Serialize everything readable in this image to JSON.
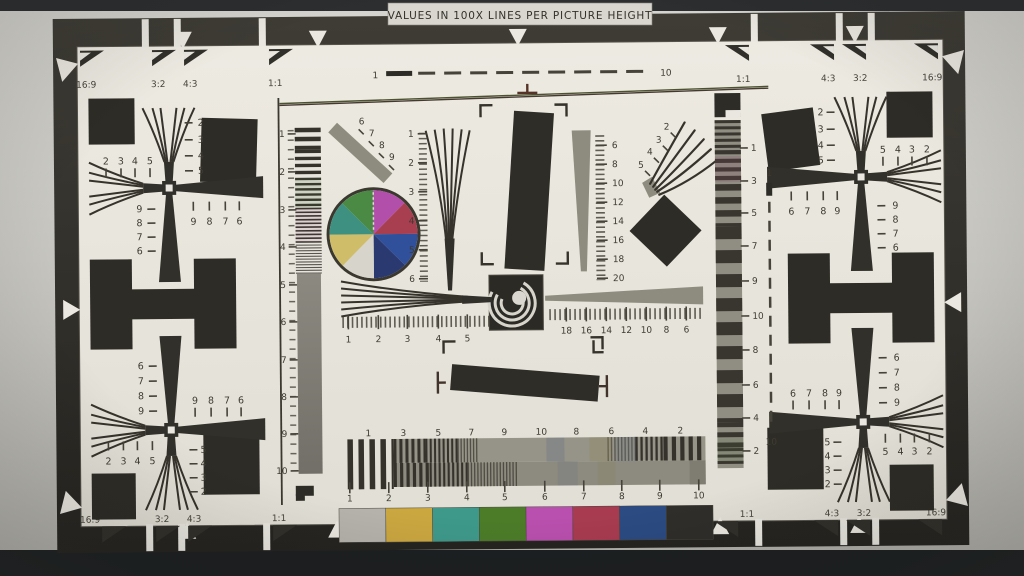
{
  "banner": {
    "text": "VALUES IN 100X LINES PER PICTURE HEIGHT"
  },
  "aspect_markers": {
    "top_left": [
      "16:9",
      "3:2",
      "4:3",
      "1:1"
    ],
    "top_right": [
      "1:1",
      "4:3",
      "3:2",
      "16:9"
    ],
    "bottom_left": [
      "16:9",
      "3:2",
      "4:3",
      "1:1"
    ],
    "bottom_right": [
      "1:1",
      "4:3",
      "3:2",
      "16:9"
    ]
  },
  "fan_crosses": {
    "upper_left": {
      "upper_column": [
        "2",
        "3",
        "4",
        "5"
      ],
      "upper_row": [
        "2",
        "3",
        "4",
        "5"
      ],
      "lower_column": [
        "9",
        "8",
        "7",
        "6"
      ],
      "lower_row": [
        "9",
        "8",
        "7",
        "6"
      ]
    },
    "lower_left": {
      "upper_column": [
        "6",
        "7",
        "8",
        "9"
      ],
      "upper_row": [
        "9",
        "8",
        "7",
        "6"
      ],
      "lower_row": [
        "2",
        "3",
        "4",
        "5"
      ],
      "lower_column": [
        "5",
        "4",
        "3",
        "2"
      ]
    },
    "upper_right": {
      "upper_column": [
        "2",
        "3",
        "4",
        "5"
      ],
      "upper_row": [
        "5",
        "4",
        "3",
        "2"
      ],
      "lower_row": [
        "6",
        "7",
        "8",
        "9"
      ],
      "lower_column": [
        "9",
        "8",
        "7",
        "6"
      ]
    },
    "lower_right": {
      "upper_column": [
        "6",
        "7",
        "8",
        "9"
      ],
      "upper_row": [
        "6",
        "7",
        "8",
        "9"
      ],
      "lower_row": [
        "5",
        "4",
        "3",
        "2"
      ],
      "lower_column": [
        "5",
        "4",
        "3",
        "2"
      ]
    }
  },
  "center_scales": {
    "top_dashed": {
      "start": "1",
      "end": "10"
    },
    "right_dashed": {
      "start": "1",
      "end": "10"
    },
    "left_strip": [
      "1",
      "2",
      "3",
      "4",
      "5",
      "6",
      "7",
      "8",
      "9",
      "10"
    ],
    "right_strip": [
      "1",
      "3",
      "5",
      "7",
      "9",
      "10",
      "8",
      "6",
      "4",
      "2"
    ],
    "center_wedge": [
      "1",
      "2",
      "3",
      "4",
      "5",
      "6"
    ],
    "diagonal_bar": [
      "6",
      "7",
      "8",
      "9"
    ],
    "ne_fan": [
      "2",
      "3",
      "4",
      "5"
    ],
    "trumpet": [
      "6",
      "8",
      "10",
      "12",
      "14",
      "16",
      "18",
      "20"
    ],
    "h_ruler_left": [
      "1",
      "2",
      "3",
      "4",
      "5"
    ],
    "h_ruler_right": [
      "18",
      "16",
      "14",
      "12",
      "10",
      "8",
      "6"
    ],
    "grating_top": [
      "1",
      "3",
      "5",
      "7",
      "9",
      "10",
      "8",
      "6",
      "4",
      "2"
    ],
    "grating_bottom": [
      "1",
      "2",
      "3",
      "4",
      "5",
      "6",
      "7",
      "8",
      "9",
      "10"
    ]
  },
  "color_wheel": {
    "slices": [
      {
        "name": "magenta",
        "color": "#b24fab"
      },
      {
        "name": "red",
        "color": "#a83f50"
      },
      {
        "name": "blue",
        "color": "#31509b"
      },
      {
        "name": "navy-blue",
        "color": "#2a3a70"
      },
      {
        "name": "white",
        "color": "#d6d4cb"
      },
      {
        "name": "yellow",
        "color": "#d0bd6a"
      },
      {
        "name": "teal",
        "color": "#3e9181"
      },
      {
        "name": "green",
        "color": "#4a8a44"
      }
    ]
  },
  "color_bars": {
    "patches": [
      {
        "name": "white",
        "color": "#b5b3ab"
      },
      {
        "name": "yellow",
        "color": "#cba740"
      },
      {
        "name": "cyan",
        "color": "#3e998a"
      },
      {
        "name": "green",
        "color": "#4c7c28"
      },
      {
        "name": "magenta",
        "color": "#b94fae"
      },
      {
        "name": "red",
        "color": "#a83b50"
      },
      {
        "name": "blue",
        "color": "#2b4b82"
      },
      {
        "name": "black",
        "color": "#302e2a"
      }
    ]
  }
}
